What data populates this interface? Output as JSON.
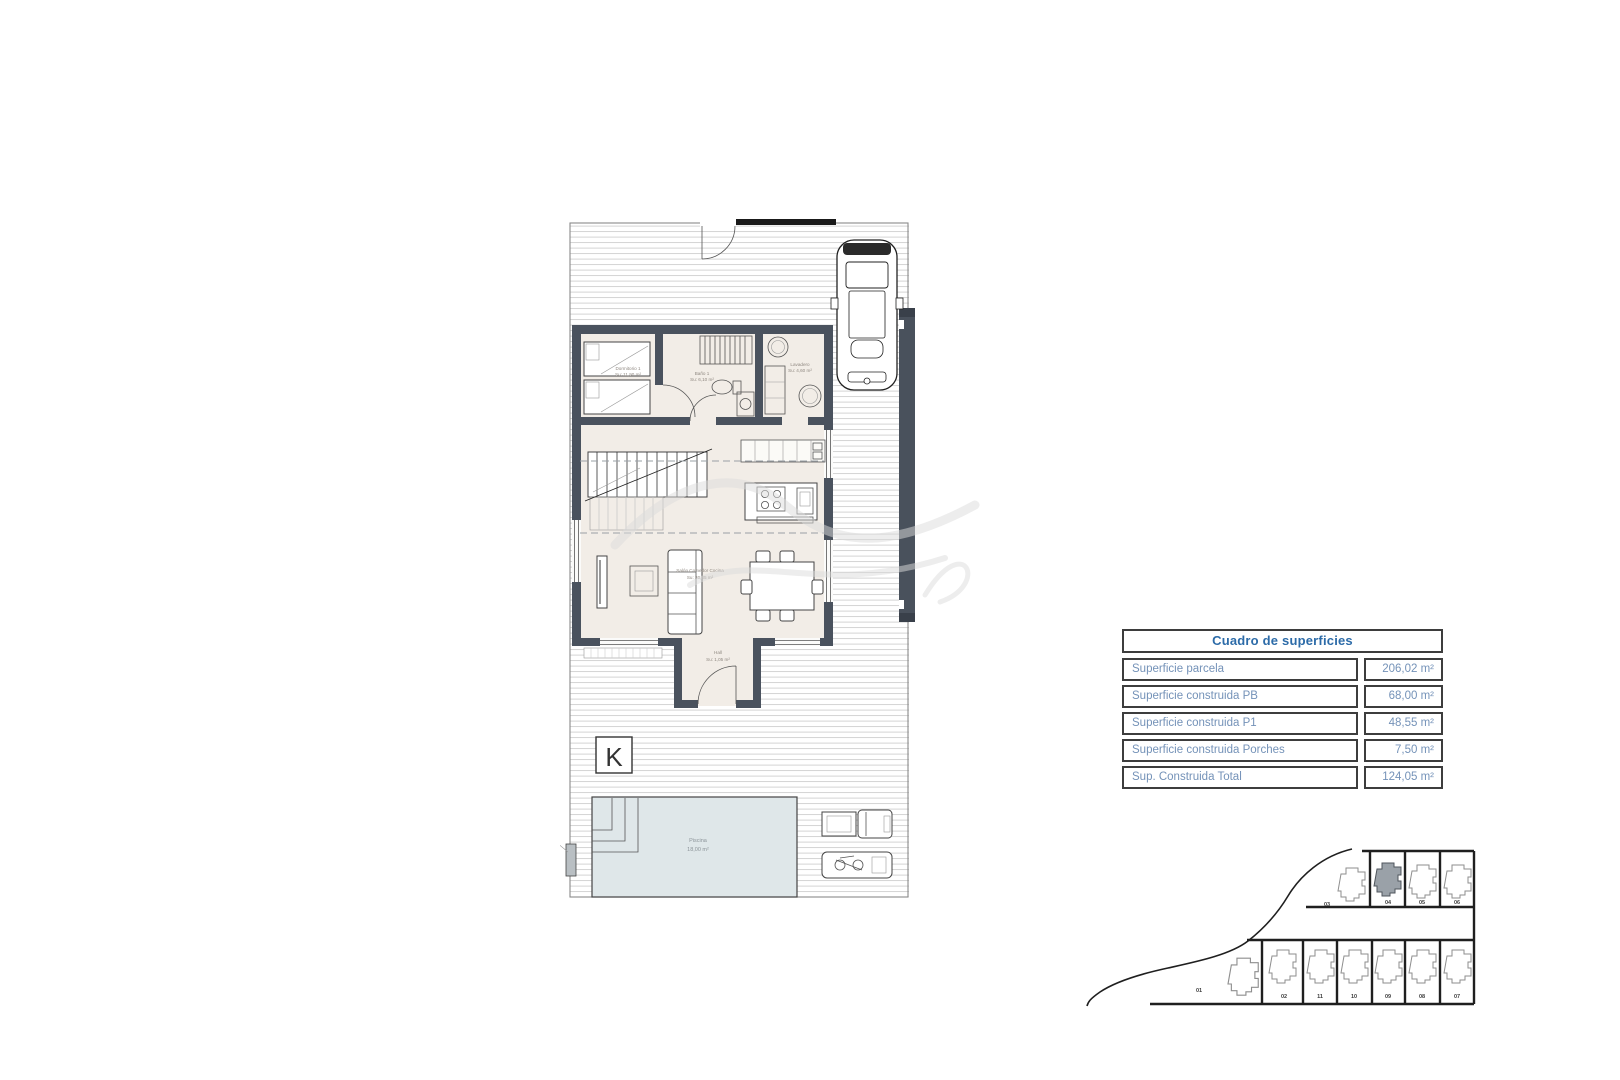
{
  "floor_plan": {
    "rooms": {
      "dormitorio1": {
        "name": "Dormitorio 1",
        "area": "Su: 11,90 m²"
      },
      "bano1": {
        "name": "Baño 1",
        "area": "Su: 6,10 m²"
      },
      "lavadero": {
        "name": "Lavadero",
        "area": "Su: 4,60 m²"
      },
      "salon": {
        "name": "Salón Comedor Cocina",
        "area": "Su: 30,85 m²"
      },
      "hall": {
        "name": "Hall",
        "area": "Su: 1,05 m²"
      },
      "piscina": {
        "name": "Piscina",
        "area": "18,00 m²"
      }
    },
    "labels": {
      "cascada": "Cascada",
      "logo": "K"
    },
    "colors": {
      "wall": "#4a525e",
      "floor": "#f2ede7",
      "pool": "#dfe7e9",
      "hatch": "#cfcfcf"
    }
  },
  "surfaces_table": {
    "title": "Cuadro de superficies",
    "rows": [
      {
        "label": "Superficie parcela",
        "value": "206,02 m²"
      },
      {
        "label": "Superficie construida PB",
        "value": "68,00 m²"
      },
      {
        "label": "Superficie construida P1",
        "value": "48,55 m²"
      },
      {
        "label": "Superficie construida Porches",
        "value": "7,50 m²"
      },
      {
        "label": "Sup. Construida Total",
        "value": "124,05 m²"
      }
    ],
    "colors": {
      "title_text": "#2c6ba8",
      "row_text": "#7492b8",
      "border": "#3d3d3d"
    }
  },
  "site_plan": {
    "highlighted_plot": "04",
    "plots_top": [
      "03",
      "04",
      "05",
      "06"
    ],
    "plots_bottom": [
      "01",
      "02",
      "11",
      "10",
      "09",
      "08",
      "07"
    ],
    "highlight_color": "#9aa1a8"
  }
}
